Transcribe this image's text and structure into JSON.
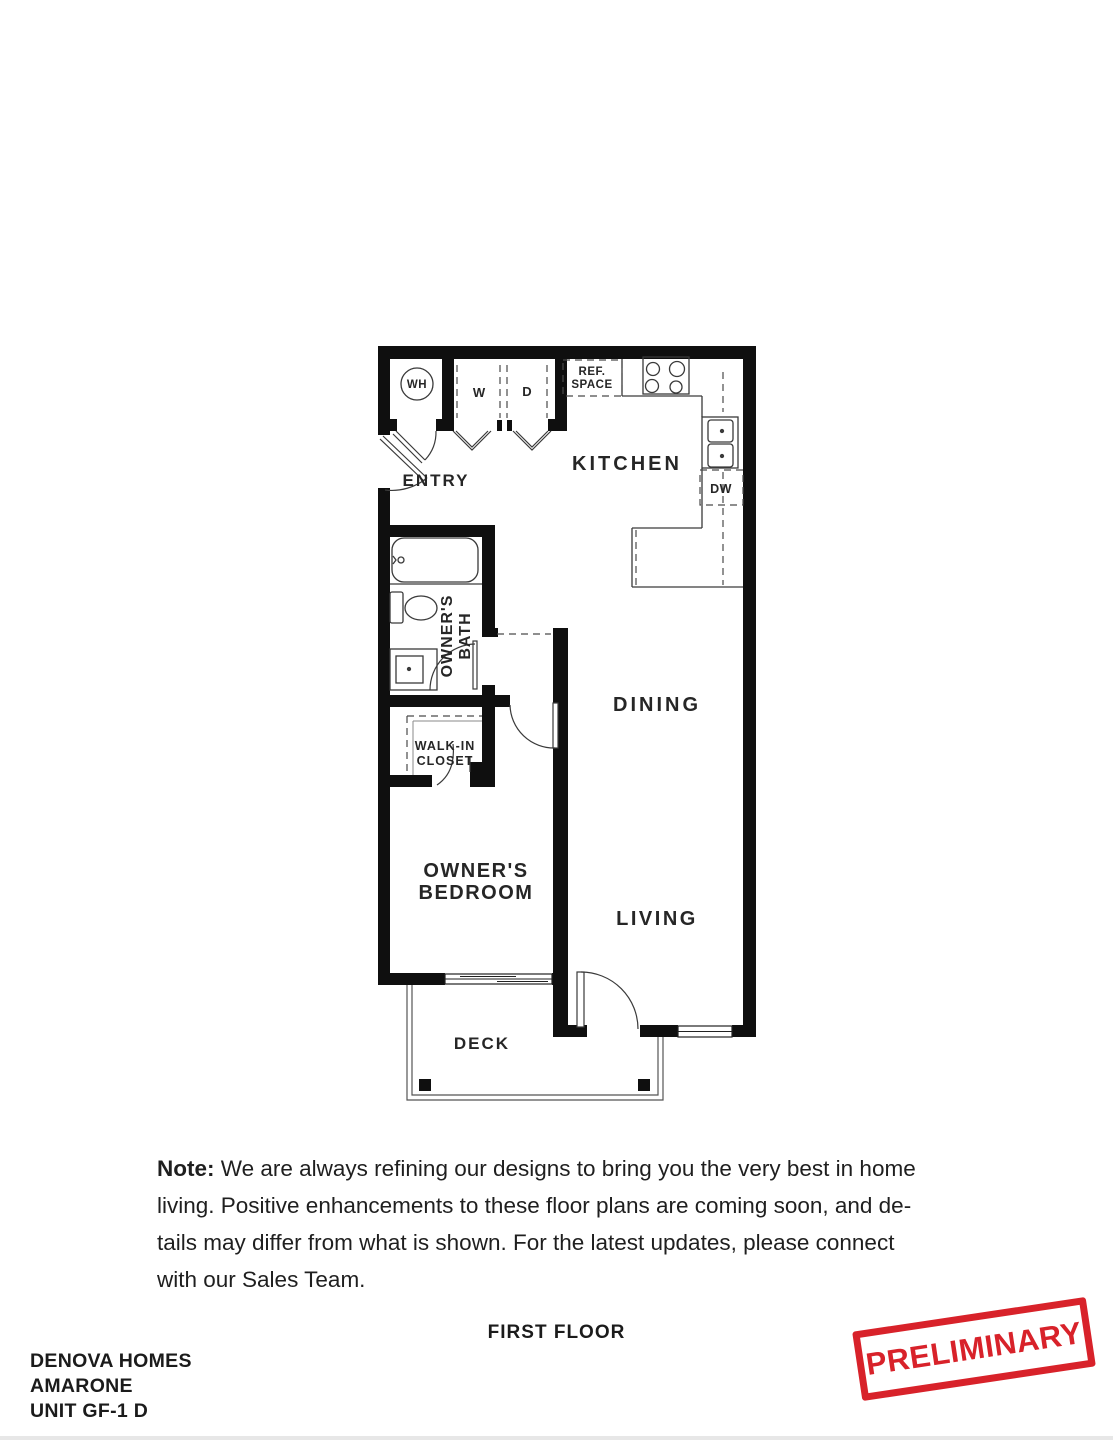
{
  "plan": {
    "rooms": {
      "entry": "ENTRY",
      "kitchen": "KITCHEN",
      "dining": "DINING",
      "living": "LIVING",
      "bedroom_line1": "OWNER'S",
      "bedroom_line2": "BEDROOM",
      "bath_line1": "OWNER'S",
      "bath_line2": "BATH",
      "closet_line1": "WALK-IN",
      "closet_line2": "CLOSET",
      "deck": "DECK"
    },
    "fixtures": {
      "water_heater": "WH",
      "washer": "W",
      "dryer": "D",
      "ref_line1": "REF.",
      "ref_line2": "SPACE",
      "dishwasher": "DW"
    },
    "wall_color": "#0f0f0f",
    "line_color": "#3a3a3a"
  },
  "note": {
    "label": "Note:",
    "line1": "We are always refining our designs to bring you the very best in home",
    "line2": "living. Positive enhancements to these floor plans are coming soon, and de-",
    "line3": "tails may differ from what is shown. For the latest updates, please connect",
    "line4": "with our Sales Team."
  },
  "footer": {
    "floor_label": "FIRST FLOOR",
    "builder": "DENOVA HOMES",
    "community": "AMARONE",
    "unit": "UNIT GF-1 D",
    "stamp": "PRELIMINARY",
    "stamp_color": "#d8222a"
  }
}
